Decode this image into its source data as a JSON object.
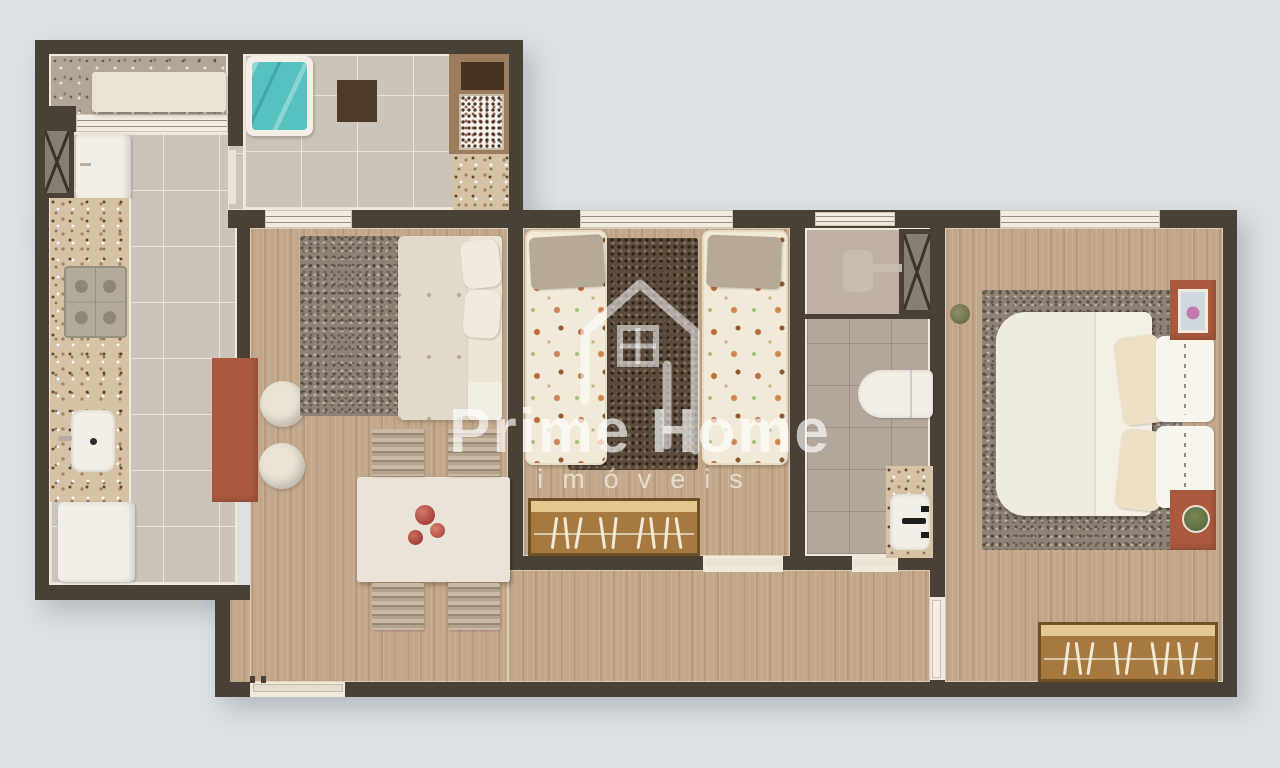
{
  "watermark": {
    "brand": "Prime Home",
    "tagline": "imóveis",
    "logo": "house-with-window-icon"
  },
  "palette": {
    "bg": "#dbe0e3",
    "wall": "#4a4136",
    "trim": "#efe9dc",
    "wood": "#c3a78a",
    "tile": "#cbc4ba",
    "bath": "#b3a79b",
    "shower": "#bfb3a5",
    "granite": "#d6c2a5",
    "balconyGranite": "#b2a797",
    "rugGray": "#8d8276",
    "rugDark": "#5a4b3d",
    "teal": "#57c1bf",
    "terracotta": "#ab5a3d",
    "cream": "#eae3d5",
    "white": "#f3efe7",
    "wardrobe": "#a5793f",
    "wardrobeTrim": "#6e5226",
    "shelf": "#e3c98f",
    "chairStripeA": "#c7b9a3",
    "chairStripeB": "#9a8872"
  },
  "scene": {
    "type": "3d-rendered apartment floor plan, top view",
    "rooms": [
      {
        "name": "balcony",
        "furniture": [
          "bench"
        ]
      },
      {
        "name": "service-area",
        "furniture": [
          "teal-daybed",
          "dark-mat",
          "barbecue-counter",
          "granite-counter"
        ]
      },
      {
        "name": "kitchen",
        "furniture": [
          "duct-shaft",
          "refrigerator",
          "granite-counter",
          "gas-cooktop",
          "sink",
          "base-appliance",
          "terracotta-peninsula",
          "two-stools"
        ]
      },
      {
        "name": "living-dining-room",
        "furniture": [
          "gray-rug",
          "sofa-with-cushions",
          "dining-table-with-centerpiece",
          "four-striped-chairs",
          "entrance-door"
        ]
      },
      {
        "name": "kids-bedroom",
        "furniture": [
          "single-bed-patterned",
          "single-bed-patterned",
          "dark-shag-rug",
          "open-wardrobe-with-hangers",
          "window"
        ]
      },
      {
        "name": "bathroom",
        "furniture": [
          "shower",
          "duct-shaft",
          "toilet",
          "granite-sink-counter"
        ]
      },
      {
        "name": "hallway",
        "furniture": []
      },
      {
        "name": "master-bedroom",
        "furniture": [
          "double-bed",
          "gray-rug",
          "two-terracotta-nightstands",
          "picture-frame",
          "plant",
          "open-wardrobe-with-hangers",
          "window"
        ]
      }
    ]
  }
}
